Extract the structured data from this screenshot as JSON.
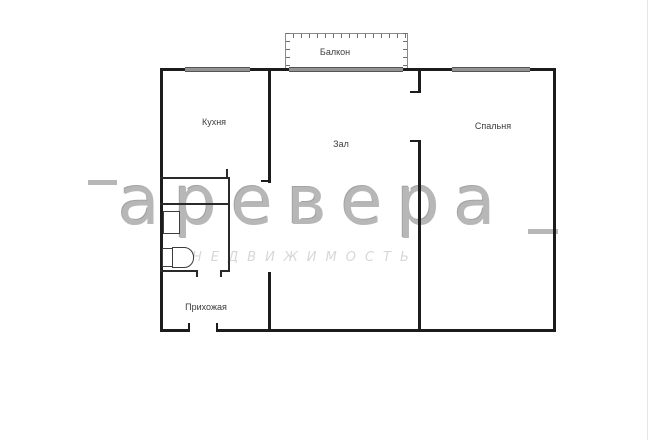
{
  "plan": {
    "type": "apartment-floorplan",
    "rooms": {
      "balcony": {
        "label": "Балкон"
      },
      "kitchen": {
        "label": "Кухня"
      },
      "hall": {
        "label": "Зал"
      },
      "bedroom": {
        "label": "Спальня"
      },
      "entry": {
        "label": "Прихожая"
      }
    },
    "fixtures": [
      "sink",
      "toilet"
    ],
    "watermark": {
      "brand": "аревера",
      "subtitle": "НЕДВИЖИМОСТЬ"
    },
    "colors": {
      "background": "#ffffff",
      "wall": "#1c1c1c",
      "window": "#949494",
      "railing": "#8a8a8a",
      "room_label": "#3c3c3c",
      "watermark_brand": "#a6a6a6",
      "watermark_subtitle": "#d7d7d7"
    }
  }
}
